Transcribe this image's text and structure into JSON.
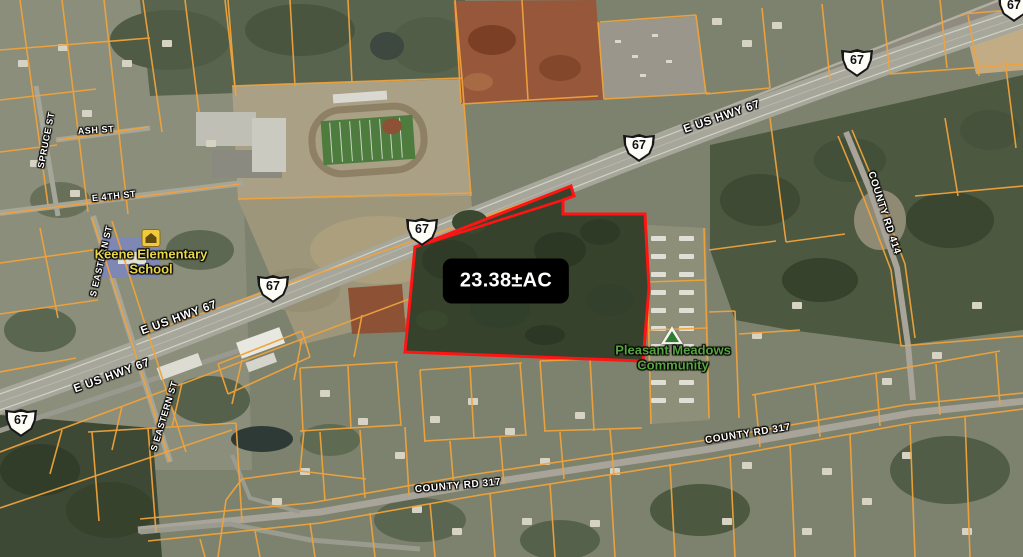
{
  "map": {
    "shield_label": "67",
    "street_labels": {
      "spruce": "SPRUCE ST",
      "ash": "ASH ST",
      "e4th": "E 4TH ST",
      "eastern_upper": "S EASTERN ST",
      "eastern_lower": "S EASTERN ST",
      "hwy_right": "E US HWY 67",
      "hwy_mid": "E US HWY 67",
      "hwy_left": "E US HWY 67",
      "cr414": "COUNTY RD 414",
      "cr317_right": "COUNTY RD 317",
      "cr317_left": "COUNTY RD 317"
    },
    "poi_labels": {
      "school_line1": "Keene Elementary",
      "school_line2": "School",
      "community_line1": "Pleasant Meadows",
      "community_line2": "Community"
    },
    "parcel": {
      "area": "23.38±AC",
      "vertices": [
        [
          415,
          247
        ],
        [
          566,
          188
        ],
        [
          571,
          186
        ],
        [
          574,
          196
        ],
        [
          563,
          200
        ],
        [
          563,
          214
        ],
        [
          645,
          214
        ],
        [
          649,
          288
        ],
        [
          643,
          361
        ],
        [
          405,
          352
        ]
      ],
      "sliver_edge": [
        [
          563,
          200
        ],
        [
          415,
          247
        ]
      ]
    },
    "colors": {
      "parcel_outline": "#ff1414",
      "cadastral_line": "#efa23b",
      "street_label": "#ffffff",
      "school_label": "#e9d74b",
      "community_label": "#55a43e",
      "area_label_bg": "#000000",
      "area_label_text": "#ffffff"
    }
  }
}
